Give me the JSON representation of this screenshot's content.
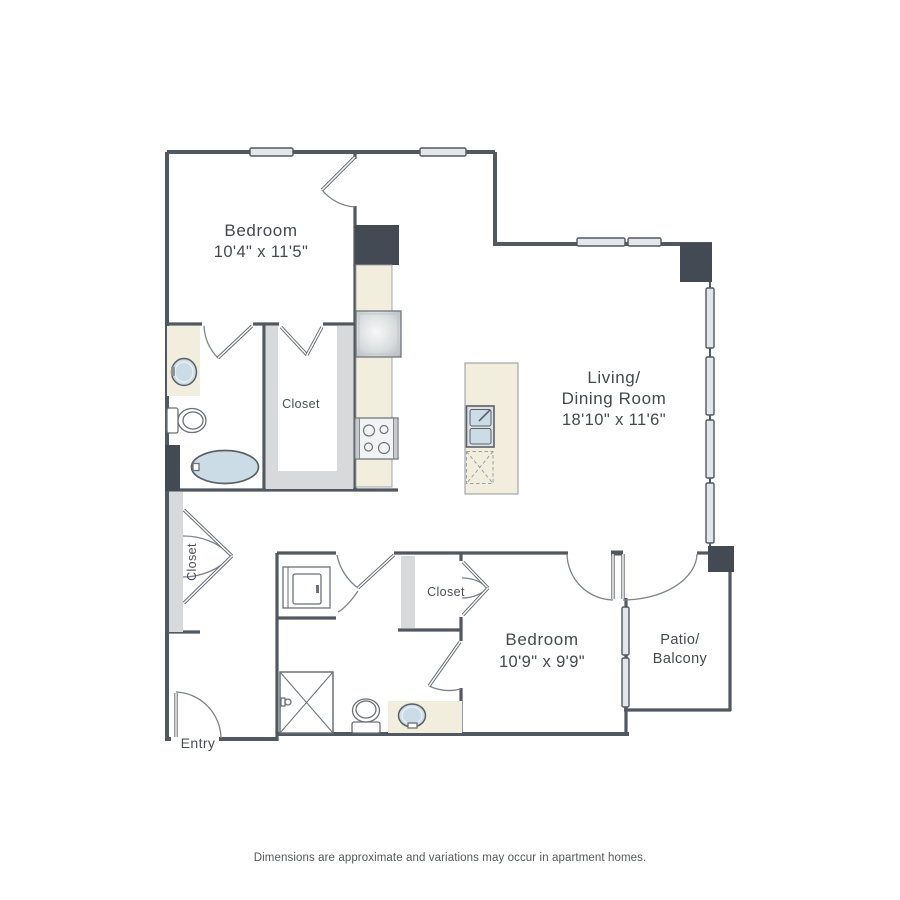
{
  "rooms": {
    "bedroom1": {
      "label": "Bedroom",
      "dimensions": "10'4\" x 11'5\""
    },
    "living": {
      "label_line1": "Living/",
      "label_line2": "Dining Room",
      "dimensions": "18'10\" x 11'6\""
    },
    "bedroom2": {
      "label": "Bedroom",
      "dimensions": "10'9\" x 9'9\""
    },
    "patio": {
      "label_line1": "Patio/",
      "label_line2": "Balcony"
    }
  },
  "closets": {
    "bedroom1_closet": {
      "label": "Closet"
    },
    "bedroom2_closet": {
      "label": "Closet"
    },
    "entry_closet": {
      "label": "Closet"
    }
  },
  "entry": {
    "label": "Entry"
  },
  "footer": {
    "disclaimer": "Dimensions are approximate and variations may occur in apartment homes."
  },
  "colors": {
    "wall": "#515860",
    "structural_block": "#434a53",
    "counter_beige": "#f1eedd",
    "closet_gray": "#d8d9da",
    "window_fill": "#e4e7e9",
    "fixture_blue": "#ccdce7",
    "label_text": "#45494f"
  },
  "fixtures": [
    "bathtub",
    "toilet",
    "vanity-sink",
    "shower",
    "washer-dryer",
    "refrigerator",
    "stove",
    "island-sink",
    "dishwasher"
  ]
}
